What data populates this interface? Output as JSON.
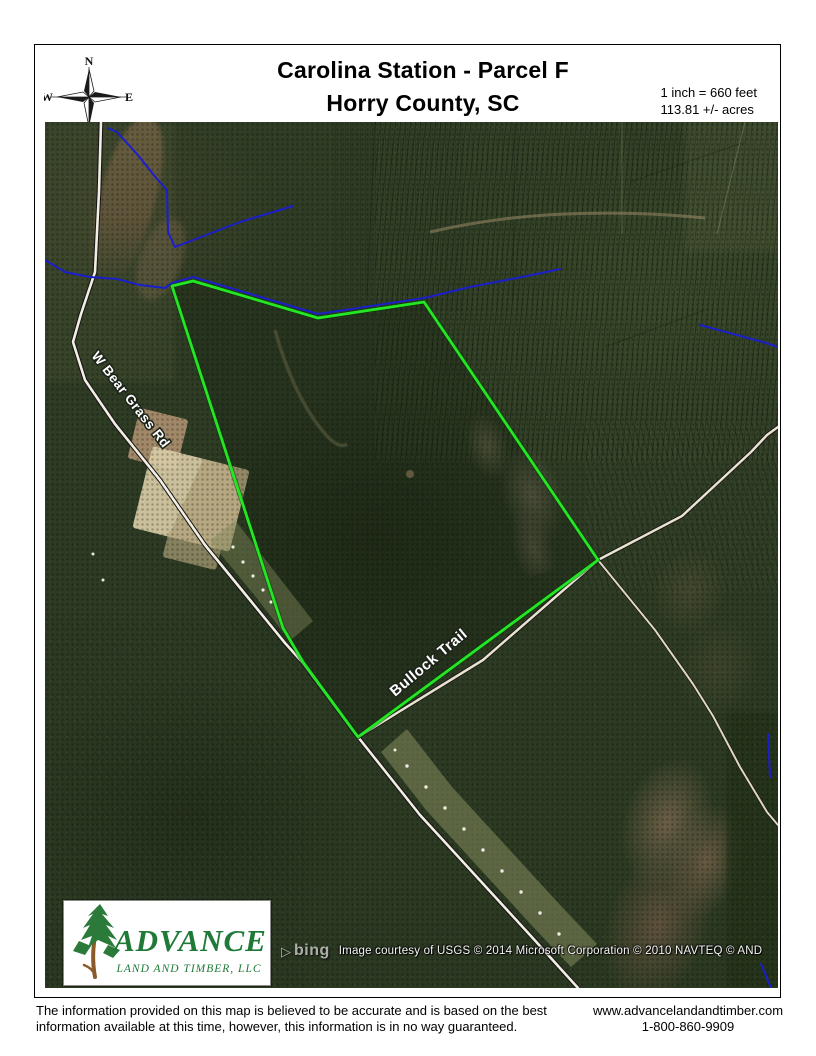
{
  "header": {
    "title_line1": "Carolina Station - Parcel F",
    "title_line2": "Horry County, SC",
    "scale_line1": "1 inch = 660 feet",
    "scale_line2": "113.81 +/- acres",
    "compass": {
      "n": "N",
      "s": "S",
      "e": "E",
      "w": "W"
    }
  },
  "map": {
    "road_labels": [
      {
        "text": "W Bear Grass Rd"
      },
      {
        "text": "Bullock Trail"
      }
    ],
    "attribution": {
      "bing_glyph": "▷",
      "bing_label": "bing",
      "text": "Image courtesy of USGS © 2014 Microsoft Corporation © 2010 NAVTEQ © AND"
    },
    "logo": {
      "name_top": "ADVANCE",
      "name_bottom": "LAND AND TIMBER, LLC"
    },
    "colors": {
      "parcel_boundary": "#25e625",
      "stream_blue": "#1b1fca",
      "road_fill": "#f2eee4",
      "road_casing": "#151515",
      "logo_green": "#1f7a38"
    }
  },
  "footer": {
    "disclaimer_line1": "The information provided on this map is believed to be accurate and is based on the best",
    "disclaimer_line2": "information available at this time, however, this information is in no way guaranteed.",
    "website": "www.advancelandandtimber.com",
    "phone": "1-800-860-9909"
  }
}
